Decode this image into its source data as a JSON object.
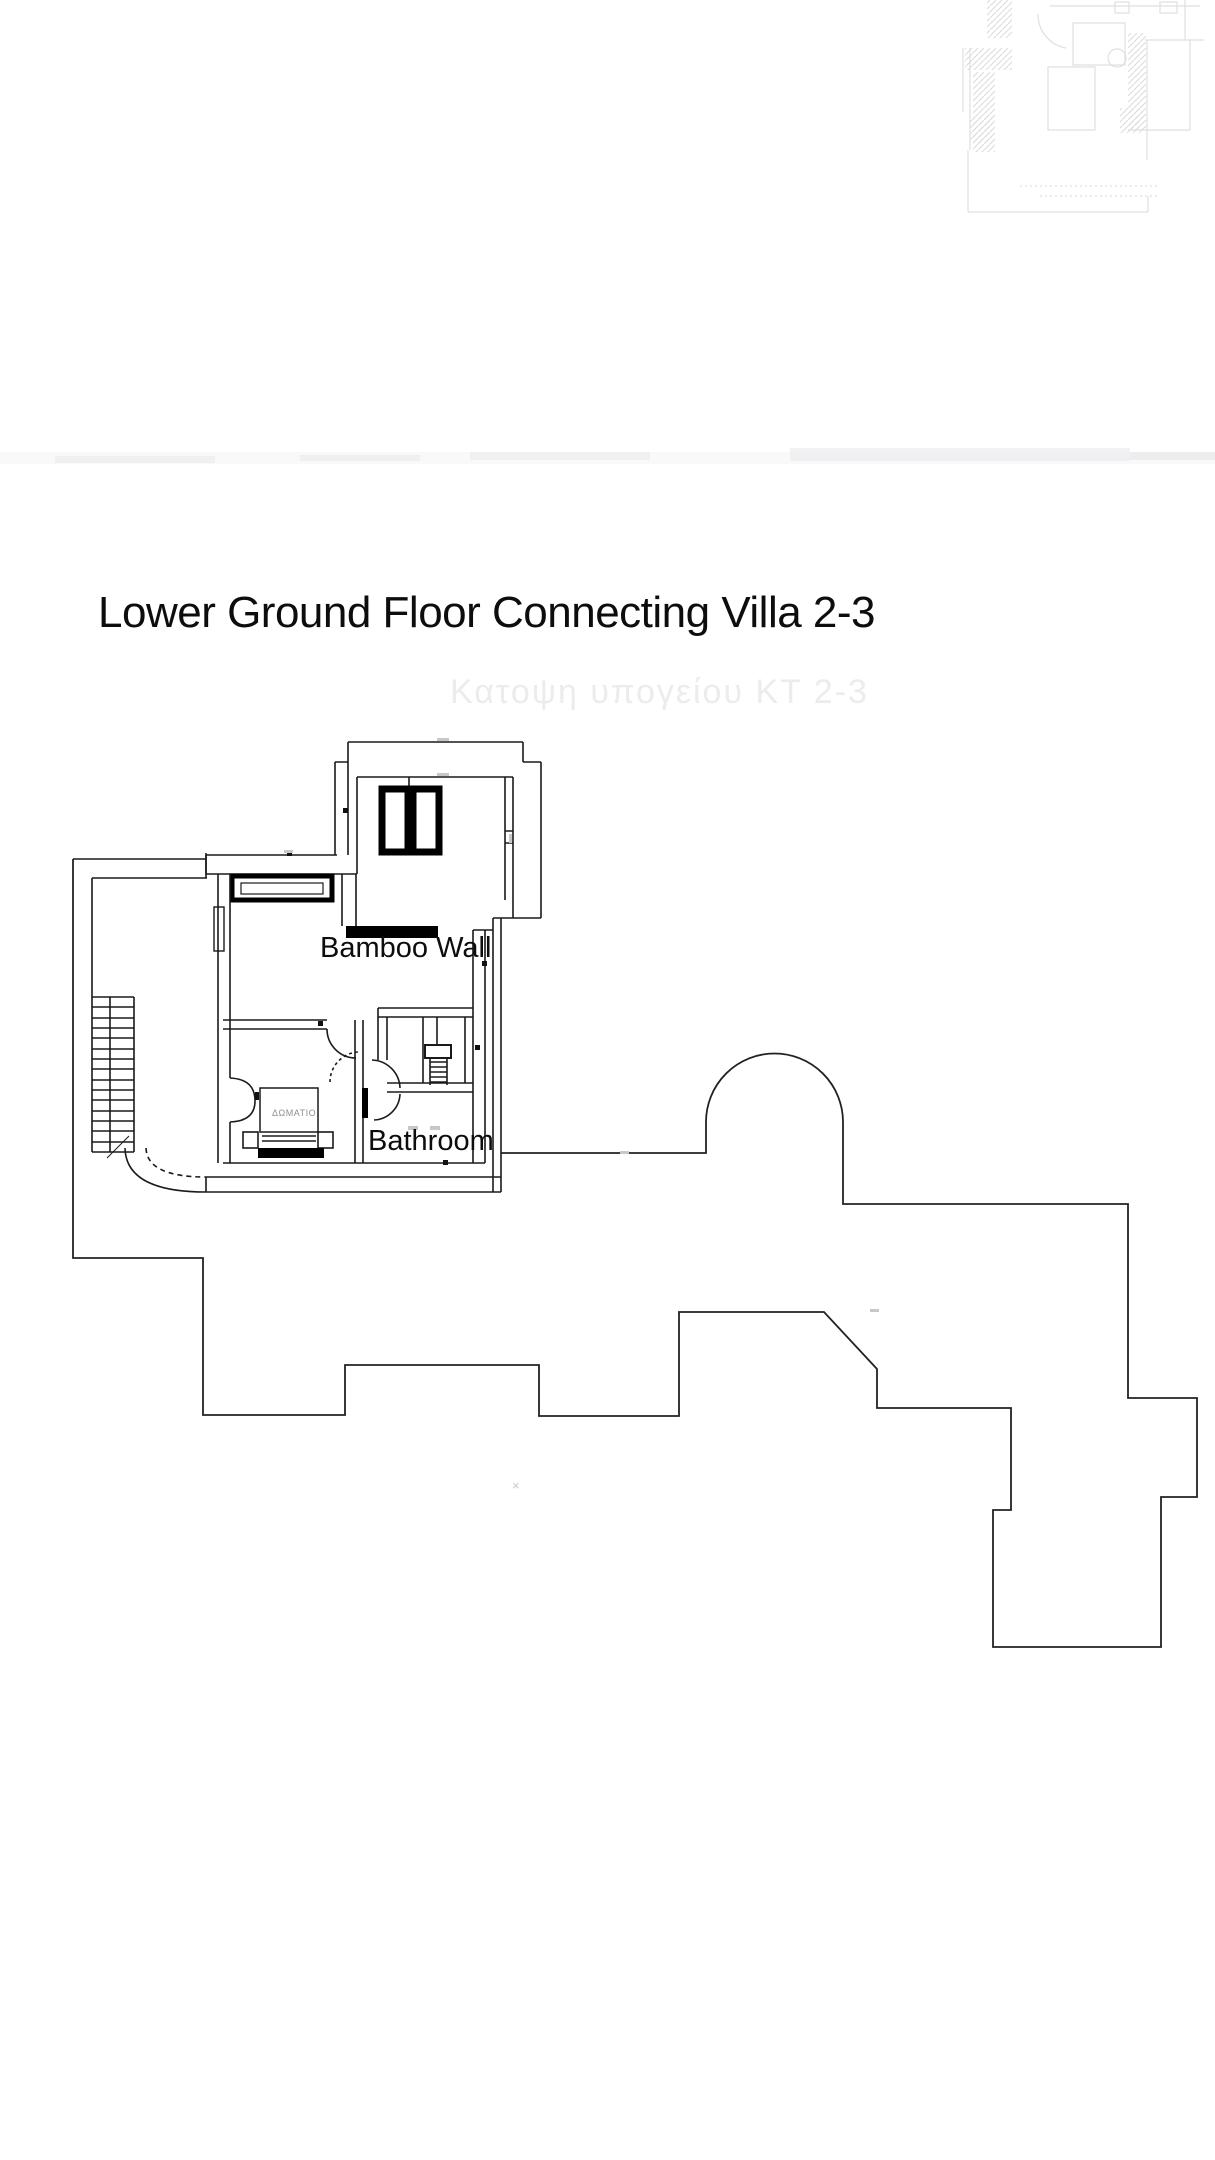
{
  "page": {
    "title": "Lower Ground Floor Connecting Villa 2-3",
    "watermark": "Κατοψη υπογείου ΚΤ 2-3",
    "stray_mark": "×"
  },
  "plan": {
    "labels": {
      "bamboo_wall": "Bamboo Wall",
      "bathroom": "Bathroom",
      "bedroom": "ΔΩΜΑΤΙΟ"
    },
    "colors": {
      "ink": "#1a1a1a",
      "outline": "#222222",
      "faint_fragment": "#dce0e2",
      "paper": "#ffffff"
    }
  }
}
